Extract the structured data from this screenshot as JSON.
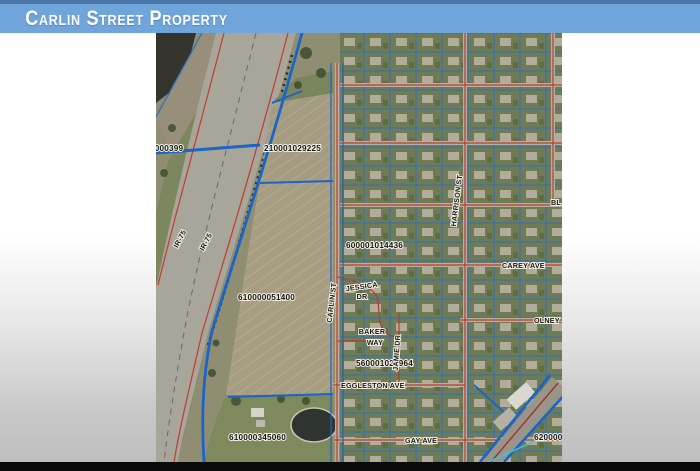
{
  "banner": {
    "title": "Carlin Street Property"
  },
  "map": {
    "parcel_labels": [
      {
        "text": "1000399"
      },
      {
        "text": "210001029225"
      },
      {
        "text": "600001014436"
      },
      {
        "text": "610000051400"
      },
      {
        "text": "560001021964"
      },
      {
        "text": "610000345060"
      },
      {
        "text": "620000"
      }
    ],
    "street_labels": [
      {
        "text": "IR-75"
      },
      {
        "text": "IR-75"
      },
      {
        "text": "CARLIN ST"
      },
      {
        "text": "HARRISON ST"
      },
      {
        "text": "JESSICA"
      },
      {
        "text": "DR"
      },
      {
        "text": "BAKER"
      },
      {
        "text": "WAY"
      },
      {
        "text": "JAMIE DR"
      },
      {
        "text": "CAREY AVE"
      },
      {
        "text": "OLNEY"
      },
      {
        "text": "EGGLESTON AVE"
      },
      {
        "text": "GAY AVE"
      },
      {
        "text": "BL"
      }
    ],
    "colors": {
      "banner_blue": "#6fa5da",
      "banner_stripe": "#4a77a8",
      "parcel_line_blue": "#1b64c8",
      "route_red": "#c0392b",
      "utility_cyan": "#35c8dc"
    }
  }
}
